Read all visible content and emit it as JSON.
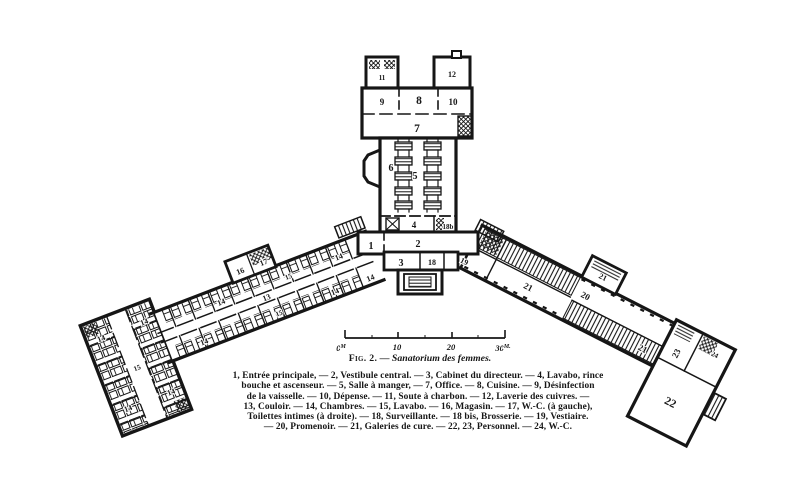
{
  "figure": {
    "caption": {
      "figure_label": "Fig. 2.",
      "dash": "—",
      "title": "Sanatorium des femmes."
    },
    "legend_lines": [
      "1, Entrée principale, — 2, Vestibule central. — 3, Cabinet du directeur. — 4, Lavabo, rince",
      "bouche et ascenseur. — 5, Salle à manger, — 7, Office. — 8, Cuisine. — 9, Désinfection",
      "de la vaisselle. — 10, Dépense. — 11, Soute à charbon. — 12, Laverie des cuivres. —",
      "13, Couloir. — 14, Chambres. — 15, Lavabo. — 16, Magasin. — 17, W.-C. (à gauche),",
      "Toilettes intimes (à droite). — 18, Surveillante. — 18 bis, Brosserie. — 19, Vestiaire.",
      "— 20, Promenoir. — 21, Galeries de cure. — 22, 23, Personnel. — 24, W.-C."
    ]
  },
  "scale_bar": {
    "zero": "0",
    "zero_unit": "M",
    "ten": "10",
    "twenty": "20",
    "thirty": "30",
    "thirty_unit": "M."
  },
  "plan_labels": {
    "n1": "1",
    "n2": "2",
    "n3": "3",
    "n4": "4",
    "n5": "5",
    "n6": "6",
    "n7": "7",
    "n8": "8",
    "n9": "9",
    "n10": "10",
    "n11": "11",
    "n12": "12",
    "n13": "13",
    "n14": "14",
    "n15": "15",
    "n16": "16",
    "n17": "17",
    "n18": "18",
    "n18bis": "18b",
    "n19": "19",
    "n20": "20",
    "n21": "21",
    "n22": "22",
    "n23": "23",
    "n24": "24"
  },
  "colors": {
    "ink": "#161616",
    "paper": "#ffffff"
  }
}
